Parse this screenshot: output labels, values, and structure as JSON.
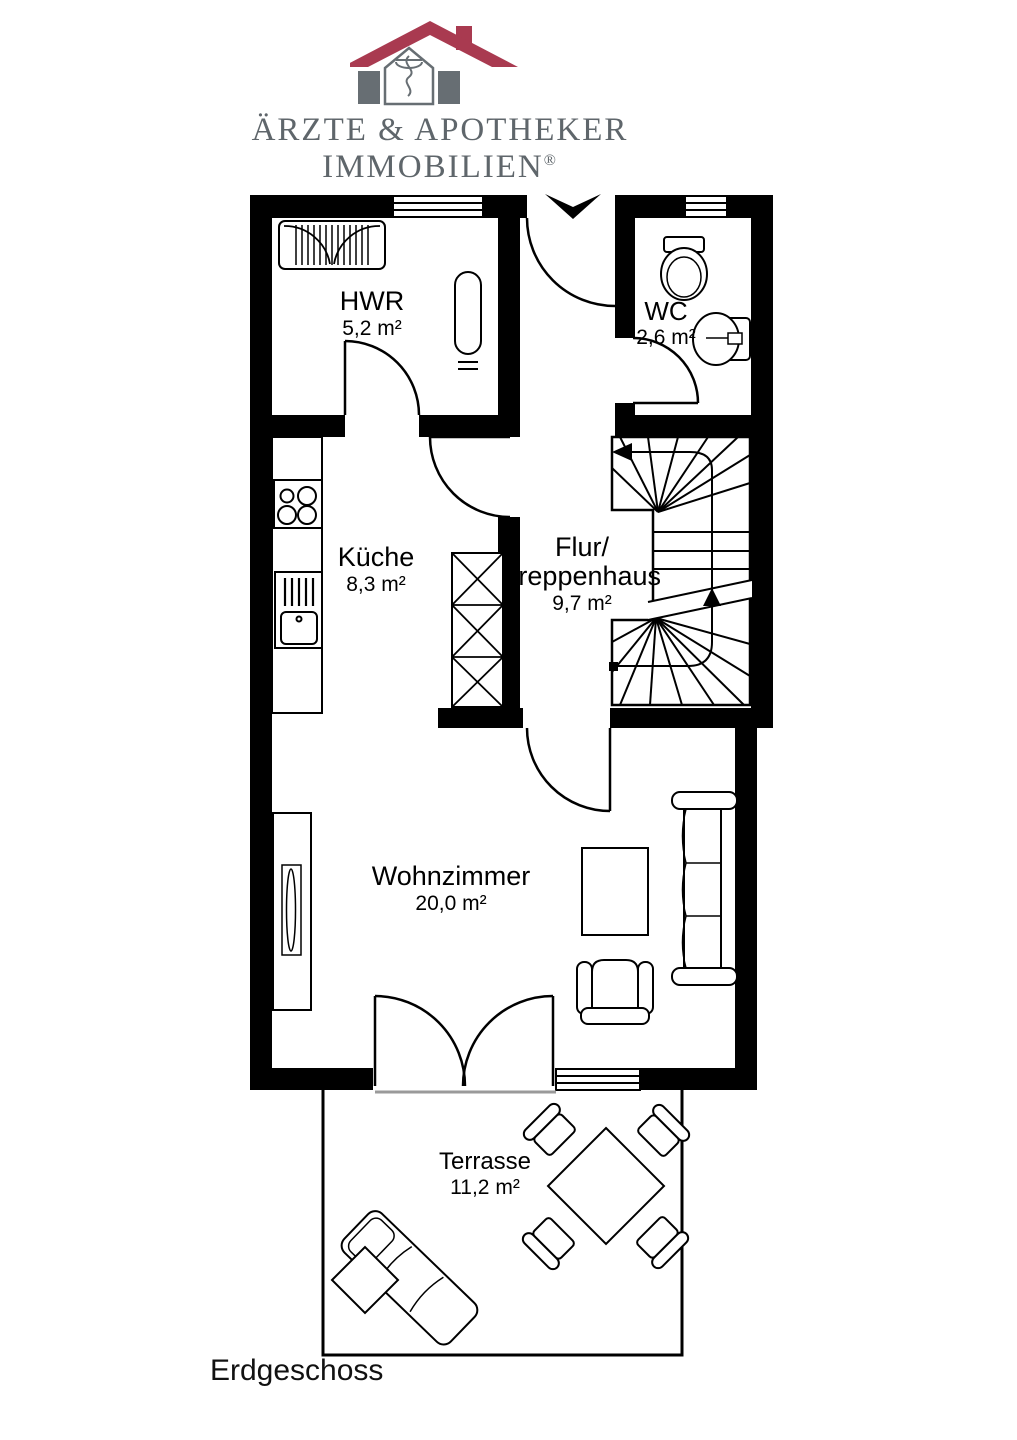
{
  "logo": {
    "line1": "ÄRZTE & APOTHEKER",
    "line2": "IMMOBILIEN",
    "registered_mark": "®",
    "icon": "house-with-aesculapius-icon",
    "colors": {
      "roof_red": "#a93a50",
      "gray": "#676e73",
      "text_gray": "#5f666b"
    }
  },
  "plan": {
    "floor_label": "Erdgeschoss",
    "rooms": [
      {
        "id": "hwr",
        "name_lines": [
          "HWR"
        ],
        "area": "5,2 m²",
        "cx": 372,
        "cy": 287
      },
      {
        "id": "wc",
        "name_lines": [
          "WC"
        ],
        "area": "2,6 m²",
        "cx": 666,
        "cy": 297
      },
      {
        "id": "kueche",
        "name_lines": [
          "Küche"
        ],
        "area": "8,3 m²",
        "cx": 376,
        "cy": 543
      },
      {
        "id": "flur",
        "name_lines": [
          "Flur/",
          "Treppenhaus"
        ],
        "area": "9,7 m²",
        "cx": 582,
        "cy": 533
      },
      {
        "id": "wohnzimmer",
        "name_lines": [
          "Wohnzimmer"
        ],
        "area": "20,0 m²",
        "cx": 451,
        "cy": 862
      },
      {
        "id": "terrasse",
        "name_lines": [
          "Terrasse"
        ],
        "area": "11,2 m²",
        "cx": 485,
        "cy": 1149
      }
    ]
  }
}
